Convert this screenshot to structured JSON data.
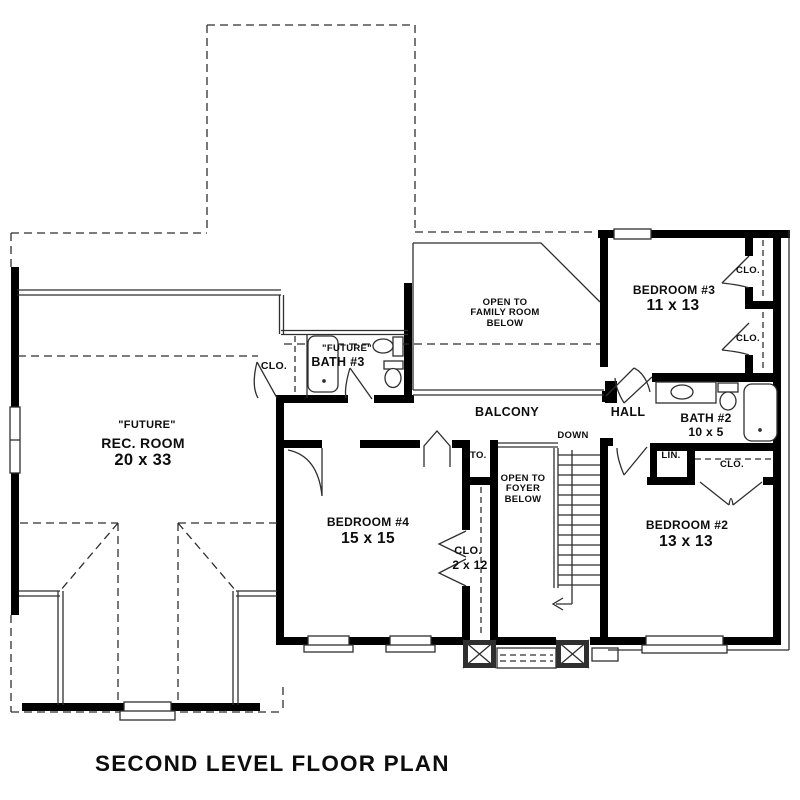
{
  "title": "SECOND LEVEL FLOOR PLAN",
  "colors": {
    "wall": "#000000",
    "line": "#2f2f2f",
    "background": "#ffffff",
    "text": "#0d0d0d"
  },
  "rooms": {
    "rec_room": {
      "tag": "\"FUTURE\"",
      "name": "REC. ROOM",
      "dims": "20 x 33"
    },
    "bath3_closet": {
      "name": "CLO."
    },
    "bath3": {
      "tag": "\"FUTURE\"",
      "name": "BATH #3"
    },
    "open_family": {
      "label": "OPEN TO\nFAMILY ROOM\nBELOW"
    },
    "bedroom3": {
      "name": "BEDROOM #3",
      "dims": "11 x 13"
    },
    "bedroom3_closet_top": {
      "name": "CLO."
    },
    "bedroom3_closet_bot": {
      "name": "CLO."
    },
    "balcony": {
      "name": "BALCONY"
    },
    "hall": {
      "name": "HALL"
    },
    "bath2": {
      "name": "BATH #2",
      "dims": "10 x 5"
    },
    "stairs": {
      "label": "DOWN"
    },
    "storage": {
      "name": "STO."
    },
    "open_foyer": {
      "label": "OPEN TO\nFOYER\nBELOW"
    },
    "linen": {
      "name": "LIN."
    },
    "bedroom2_closet": {
      "name": "CLO."
    },
    "bedroom4": {
      "name": "BEDROOM #4",
      "dims": "15 x 15"
    },
    "bedroom4_closet": {
      "name": "CLO.",
      "dims": "2 x 12"
    },
    "bedroom2": {
      "name": "BEDROOM #2",
      "dims": "13 x 13"
    }
  }
}
